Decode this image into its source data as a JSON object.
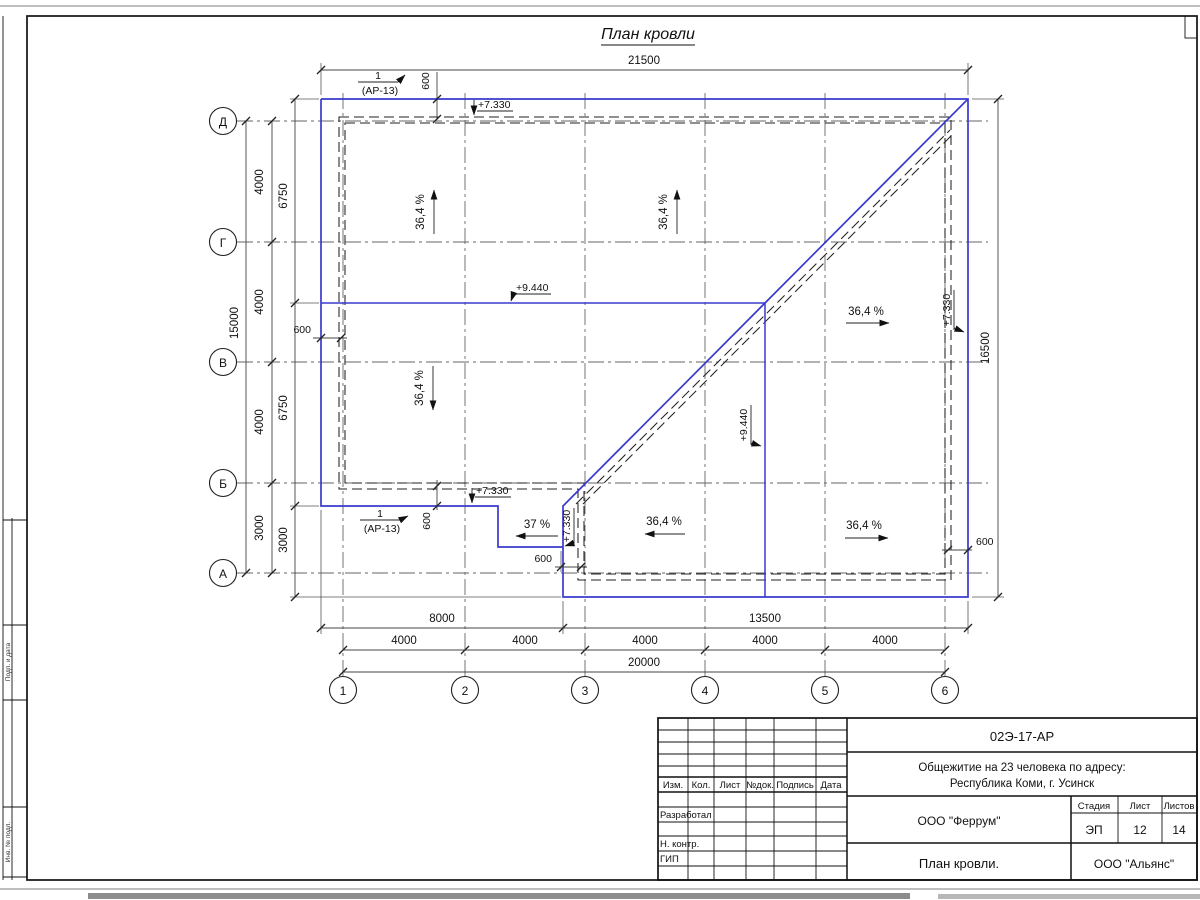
{
  "colors": {
    "roof_line": "#3a3ace",
    "ink": "#111111"
  },
  "drawing": {
    "title": "План кровли",
    "grid_rows": [
      "Д",
      "Г",
      "В",
      "Б",
      "А"
    ],
    "grid_cols": [
      "1",
      "2",
      "3",
      "4",
      "5",
      "6"
    ],
    "dim_top_total": "21500",
    "dim_left_total": "15000",
    "dim_left_seg": [
      "4000",
      "4000",
      "4000",
      "3000"
    ],
    "dim_left_inner": [
      "6750",
      "6750",
      "3000"
    ],
    "dim_right_total": "16500",
    "dim_bottom_seg": [
      "8000",
      "13500"
    ],
    "dim_bottom_grid": [
      "4000",
      "4000",
      "4000",
      "4000",
      "4000"
    ],
    "dim_bottom_total": "20000",
    "dim_overhang": "600",
    "elev_ridge": "+9.440",
    "elev_eave": "+7.330",
    "slope_main": "36,4 %",
    "slope_porch": "37 %",
    "callout_num": "1",
    "callout_ref": "(АР-13)"
  },
  "side_strip": {
    "label_1": "Подп. и дата",
    "label_2": "Инв. № подл."
  },
  "titleblock": {
    "doc_no": "02Э-17-АР",
    "object_line1": "Общежитие на 23 человека по адресу:",
    "object_line2": "Республика Коми, г. Усинск",
    "cols": [
      "Изм.",
      "Кол.",
      "Лист",
      "№док.",
      "Подпись",
      "Дата"
    ],
    "row_developed": "Разработал",
    "row_ncontr": "Н. контр.",
    "row_gip": "ГИП",
    "company": "ООО \"Феррум\"",
    "sheet_name": "План кровли.",
    "org": "ООО \"Альянс\"",
    "stage_label": "Стадия",
    "sheet_label": "Лист",
    "sheets_label": "Листов",
    "stage_value": "ЭП",
    "sheet_value": "12",
    "sheets_value": "14"
  }
}
